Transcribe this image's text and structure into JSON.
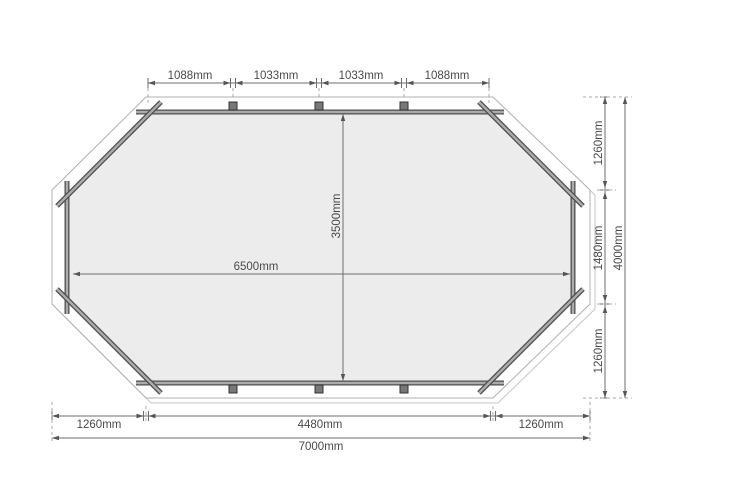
{
  "diagram": {
    "type": "technical-floor-plan",
    "shape": "elongated-octagon",
    "top_dims": [
      "1088mm",
      "1033mm",
      "1033mm",
      "1088mm"
    ],
    "interior_width": "6500mm",
    "interior_height": "3500mm",
    "right_dims": [
      "1260mm",
      "1480mm",
      "1260mm"
    ],
    "right_total": "4000mm",
    "bottom_dims": [
      "1260mm",
      "4480mm",
      "1260mm"
    ],
    "bottom_total": "7000mm",
    "colors": {
      "background": "#ffffff",
      "interior_fill": "#ececec",
      "interior_edge": "#9e9e9e",
      "beam_dark": "#4f4f4f",
      "beam_light": "#ababab",
      "outline": "#b0b0b0",
      "shadow": "#c6c6c6",
      "dimension_line": "#6e6e6e",
      "arrow": "#555555",
      "text": "#4a4a4a"
    }
  }
}
